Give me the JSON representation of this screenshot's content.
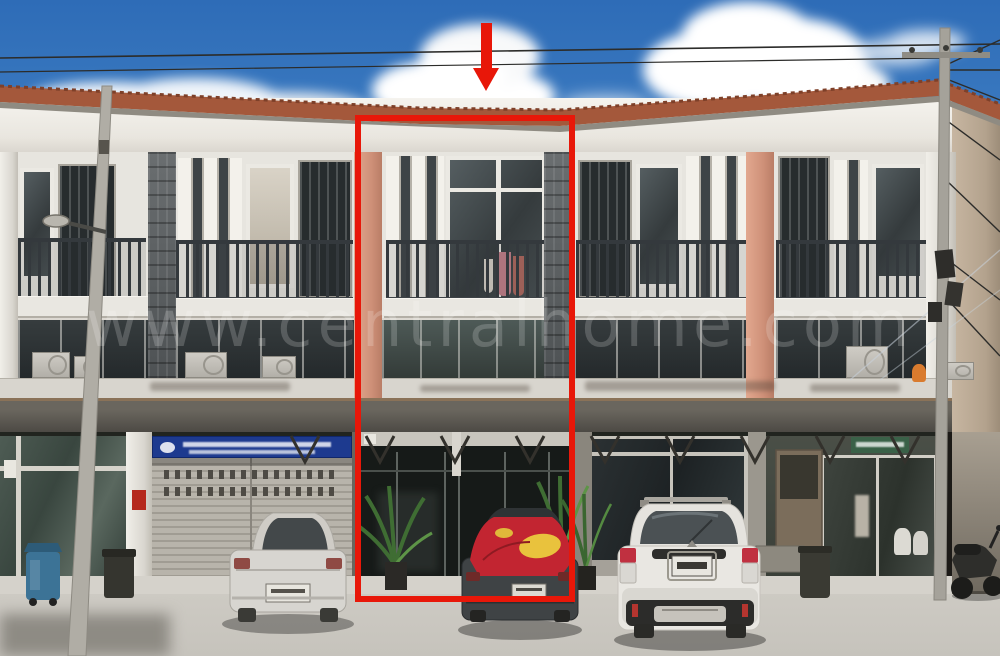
{
  "photo": {
    "type": "real-estate-photograph",
    "subject": "Three-storey commercial shophouse row, front elevation; middle unit marked",
    "watermark": {
      "text": "www.centralhome.com"
    },
    "annotations": {
      "arrow": "red-down-arrow",
      "highlight_box": {
        "x": 355,
        "y": 115,
        "width": 220,
        "height": 487,
        "color": "#e81709"
      }
    },
    "colors": {
      "annotation_red": "#e81709",
      "sky_top": "#2e6cb7",
      "sky_horizon": "#8ab4dc",
      "roof_tile": "#a4583b",
      "facade_white": "#e7e5df",
      "salmon_pillar": "#cf9179",
      "stone_pillar": "#5d6163",
      "awning_gray": "#4a4742",
      "blue_sign": "#1d3a8f",
      "green_sign": "#3a6148",
      "pavement": "#cac7c0"
    },
    "signs": [
      {
        "name": "blue-company-sign",
        "color": "#1d3a8f",
        "text_legible": false
      },
      {
        "name": "green-shop-sign",
        "color": "#3a6148",
        "text_legible": false
      }
    ],
    "vehicles": [
      {
        "name": "silver-sedan",
        "position": "left"
      },
      {
        "name": "dark-sedan-red-cover",
        "position": "center-under-highlight"
      },
      {
        "name": "white-suv",
        "position": "right"
      },
      {
        "name": "motorcycle",
        "position": "far-right"
      }
    ],
    "objects": [
      "blue-wheelie-bin",
      "black-bin",
      "utility-pole-left",
      "street-lamp",
      "utility-pole-right",
      "power-lines",
      "air-conditioner-units",
      "roller-shutter",
      "potted-plants",
      "balcony-railings",
      "clothes-on-balcony",
      "glass-storefronts"
    ]
  }
}
